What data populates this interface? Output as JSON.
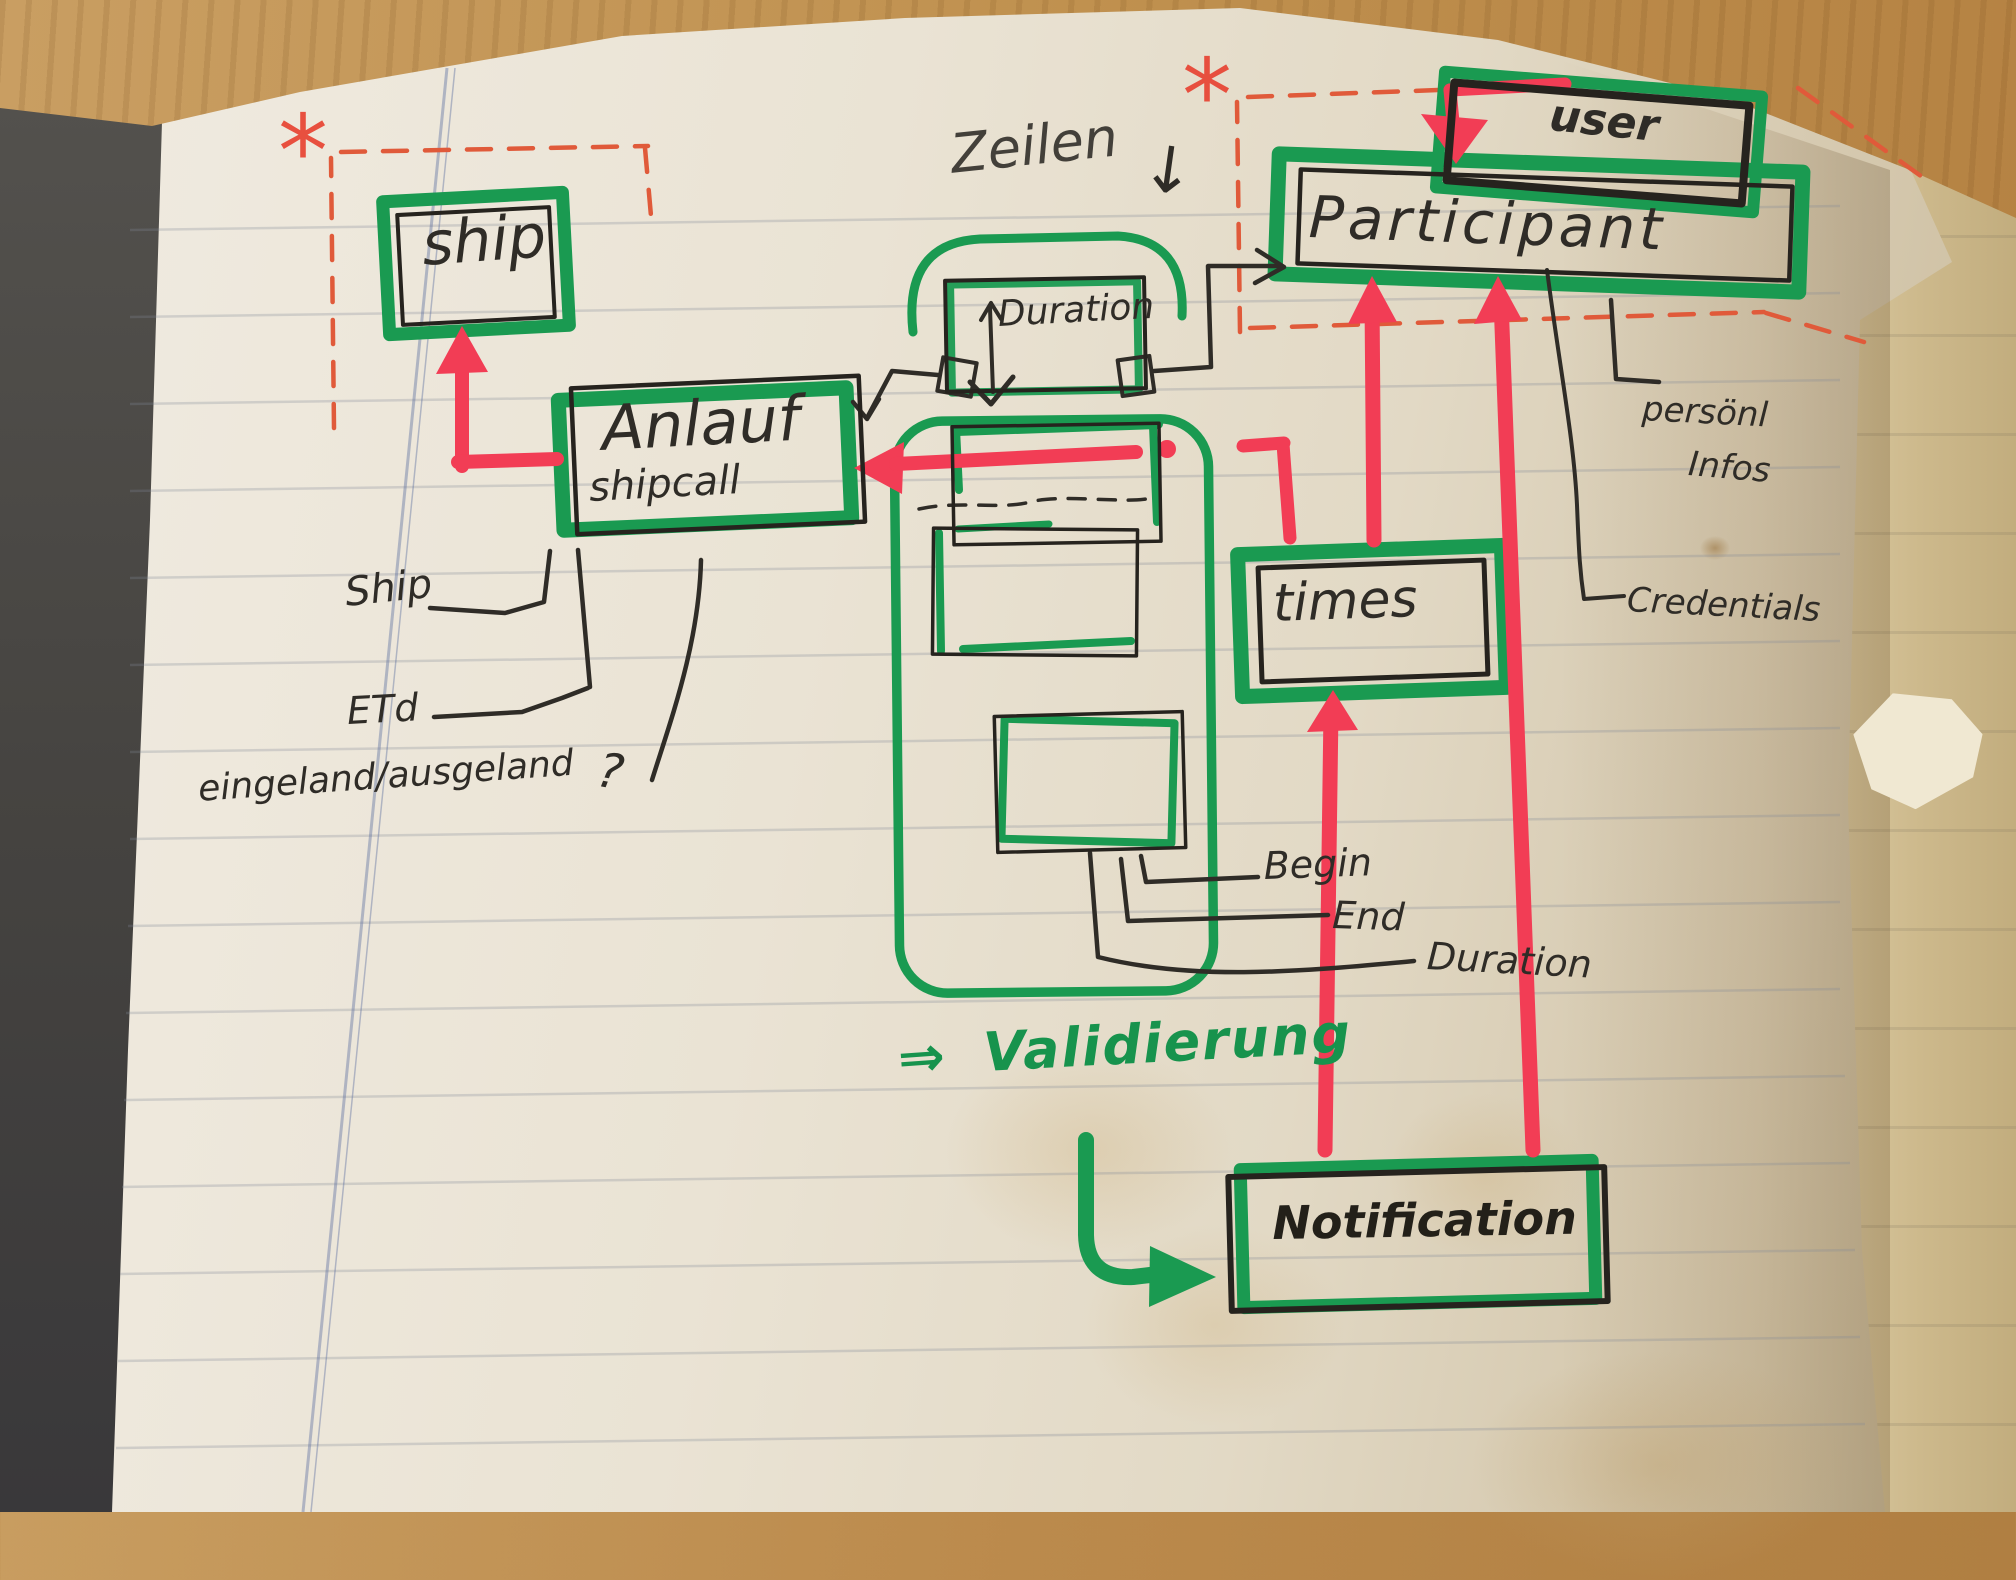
{
  "nodes": {
    "ship": {
      "label": "ship"
    },
    "anlauf": {
      "label": "Anlauf",
      "sublabel": "shipcall"
    },
    "duration": {
      "label": "Duration"
    },
    "participant": {
      "label": "Participant"
    },
    "user": {
      "label": "user"
    },
    "times": {
      "label": "times"
    },
    "notification": {
      "label": "Notification"
    }
  },
  "annotations": {
    "zeilen": "Zeilen",
    "zeilen_arrow": "↓",
    "validierung_arrow": "⇒",
    "validierung": "Validierung",
    "asterisk_ship": "*",
    "asterisk_participant": "*",
    "question_mark": "?"
  },
  "attributes": {
    "shipcall": {
      "ship": "Ship",
      "etd": "ETd",
      "inout": "eingeland/ausgeland"
    },
    "times": {
      "begin": "Begin",
      "end": "End",
      "duration": "Duration"
    },
    "participant": {
      "personal_1": "persönl",
      "personal_2": "Infos",
      "credentials": "Credentials"
    }
  },
  "colors": {
    "marker_green": "#1a9a51",
    "marker_red": "#f23d55",
    "dashed_red": "#e05a3a",
    "pen_black": "#2f2c27"
  }
}
